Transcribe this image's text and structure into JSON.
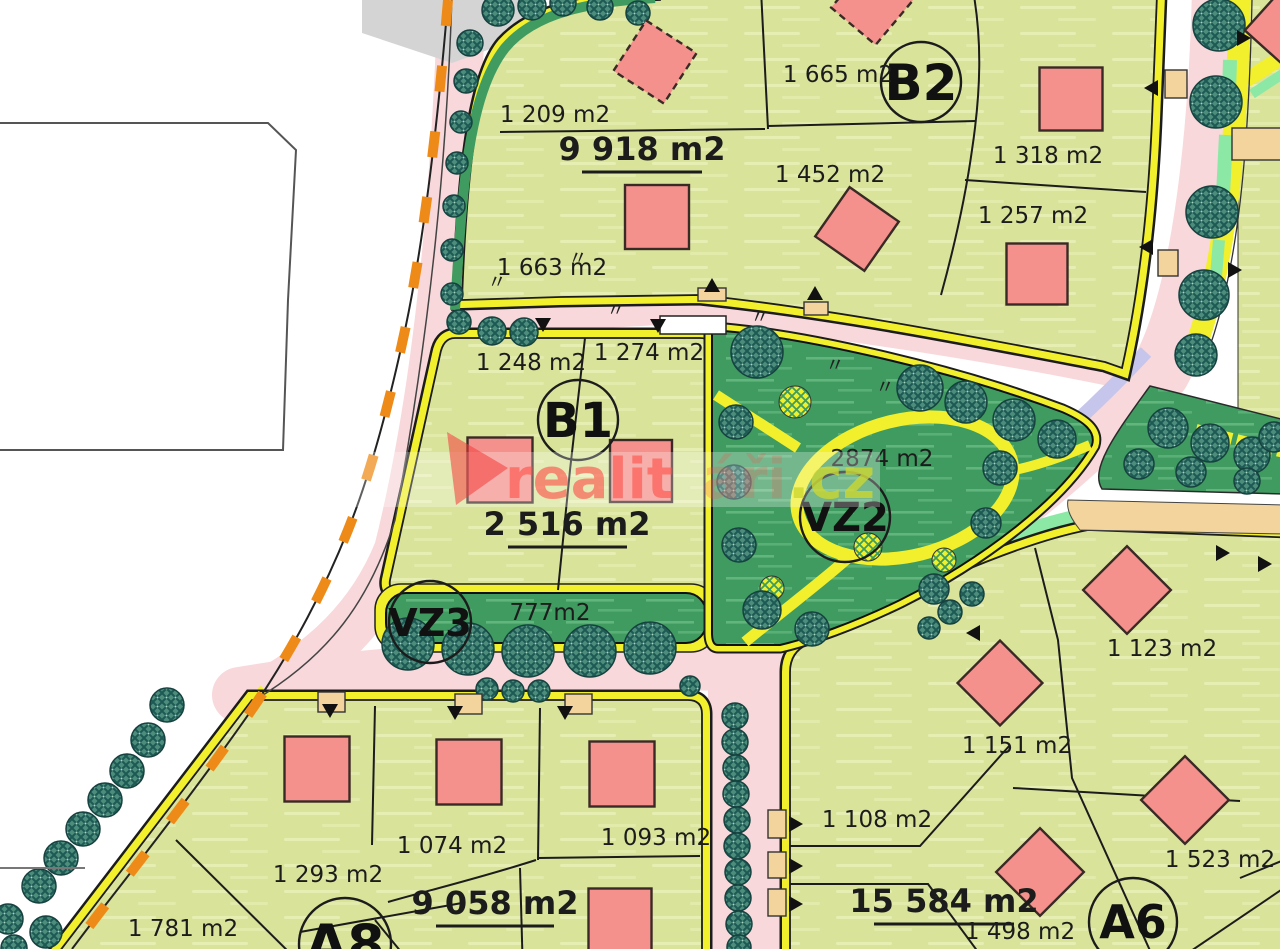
{
  "map": {
    "type": "zoning-site-plan",
    "watermark": {
      "part1": "realit",
      "part2": "áři",
      "part3": ".cz"
    },
    "zones": {
      "B1": "B1",
      "B2": "B2",
      "VZ2": "VZ2",
      "VZ3": "VZ3",
      "A8": "A8",
      "A6": "A6"
    },
    "areas": {
      "p1209": "1 209 m2",
      "p9918": "9 918 m2",
      "p1663": "1 663 m2",
      "p1665": "1 665 m2",
      "p1452": "1 452 m2",
      "p1318": "1 318 m2",
      "p1257": "1 257 m2",
      "p1248": "1 248 m2",
      "p1274": "1 274 m2",
      "p2516": "2 516 m2",
      "p2874": "2874 m2",
      "p777": "777m2",
      "p1123": "1 123 m2",
      "p1151": "1 151 m2",
      "p1293": "1 293 m2",
      "p1074": "1 074 m2",
      "p1093": "1 093 m2",
      "p9058": "9 058 m2",
      "p1781": "1 781 m2",
      "p1108": "1 108 m2",
      "p15584": "15 584 m2",
      "p1498": "1 498 m2",
      "p1523": "1 523 m2"
    },
    "marks": {
      "ditto": "〃"
    },
    "colors": {
      "road_pink": "#f8d8da",
      "parcel_green": "#d9e39a",
      "park_green": "#3f9b60",
      "house_red": "#f4918d",
      "path_yellow": "#f2ef2d",
      "boundary_orange": "#ee8a17",
      "mint": "#8ce8a5",
      "lavender": "#c6c6ec",
      "tan": "#f2d49c",
      "paved_gray": "#d4d4d4"
    }
  }
}
